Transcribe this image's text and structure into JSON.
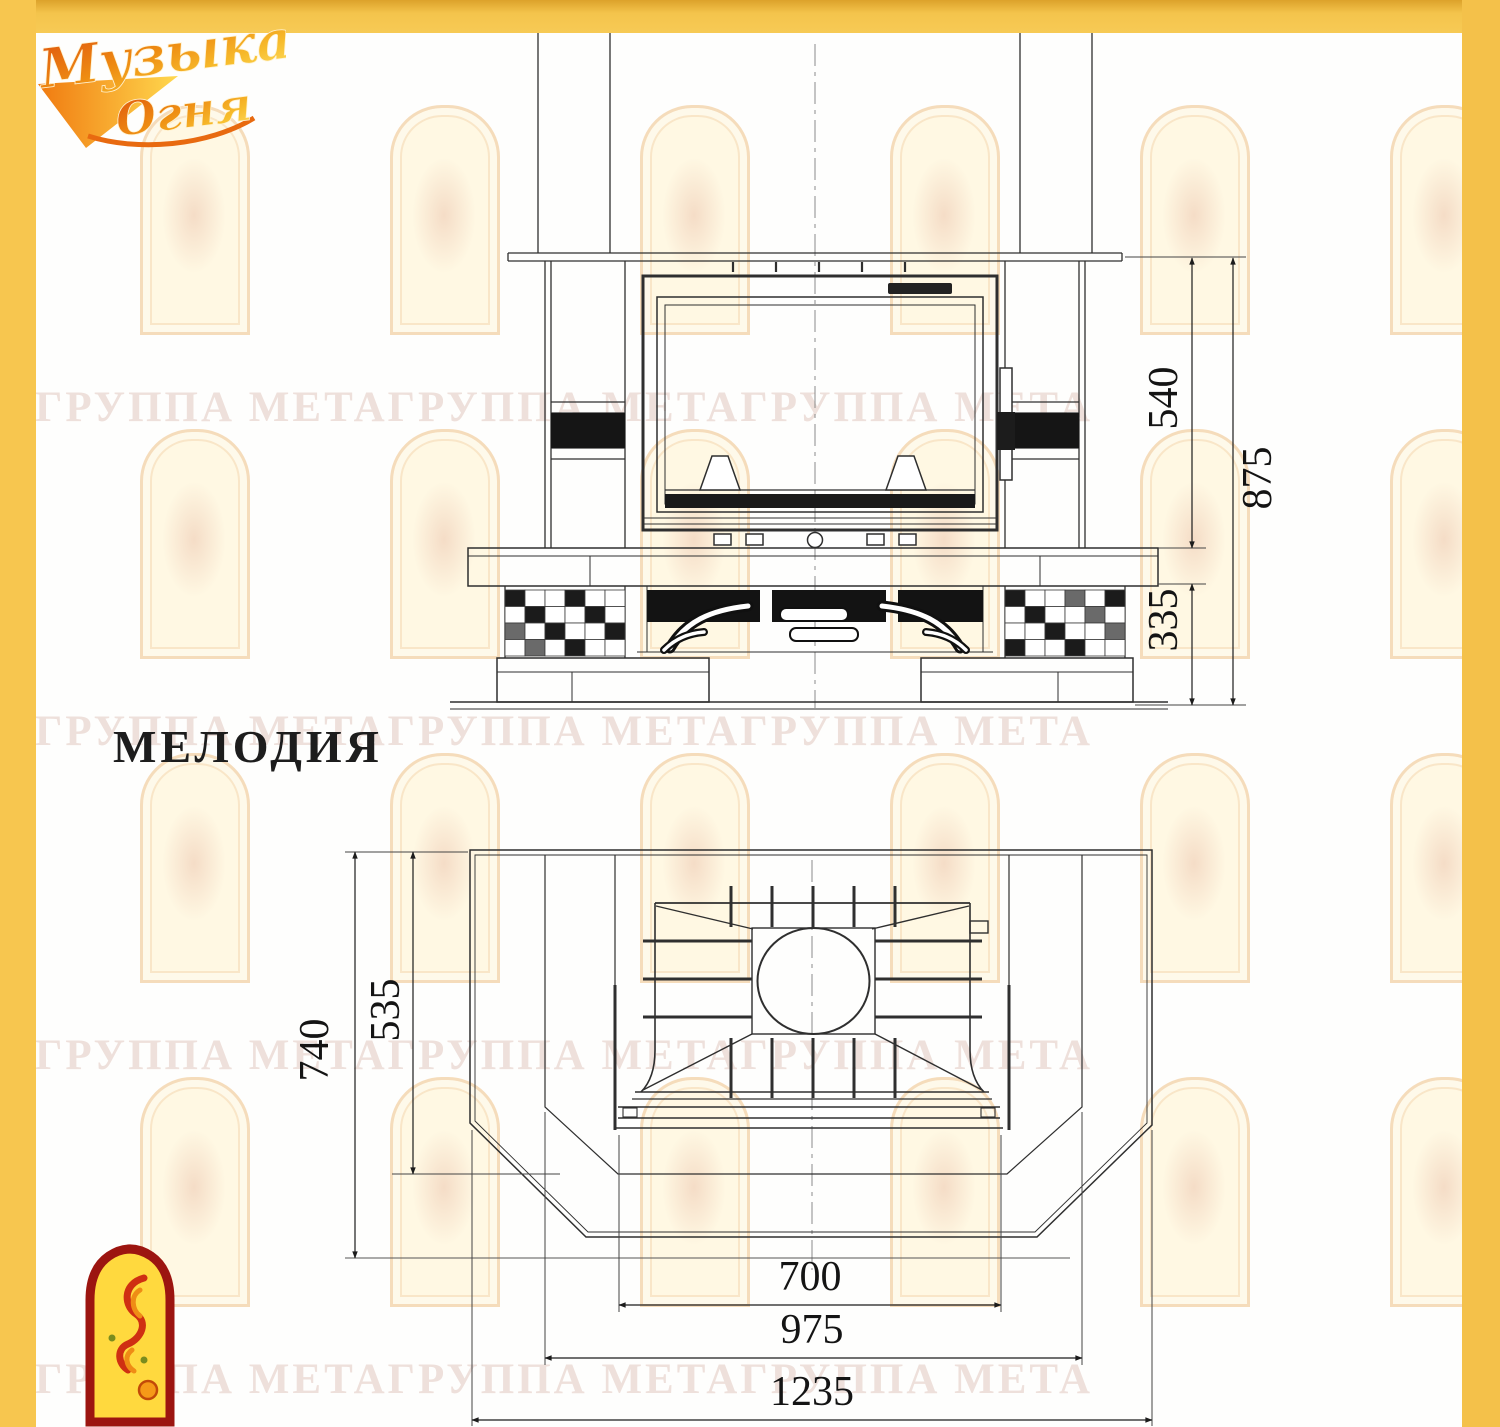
{
  "page": {
    "model_title": "МЕЛОДИЯ"
  },
  "logo": {
    "line1": "Музыка",
    "line2": "Огня"
  },
  "watermark": {
    "rows": [
      "ГРУППА МЕТАГРУППА МЕТАГРУППА МЕТА",
      "ГРУППА МЕТАГРУППА МЕТАГРУППА МЕТА",
      "ГРУППА МЕТАГРУППА МЕТАГРУППА МЕТА",
      "ГРУППА МЕТАГРУППА МЕТАГРУППА МЕТА"
    ]
  },
  "drawing": {
    "front_view": {
      "dims": {
        "firebox_height": "540",
        "overall_height": "875",
        "base_height": "335"
      }
    },
    "plan_view": {
      "dims": {
        "overall_depth": "740",
        "inner_depth": "535",
        "firebox_width": "700",
        "inner_width": "975",
        "overall_width": "1235"
      }
    }
  },
  "colors": {
    "frame_gold": "#f4c44c",
    "line": "#2f2f2f",
    "stamp_red": "#9c1510",
    "stamp_yellow": "#ffd93e"
  }
}
